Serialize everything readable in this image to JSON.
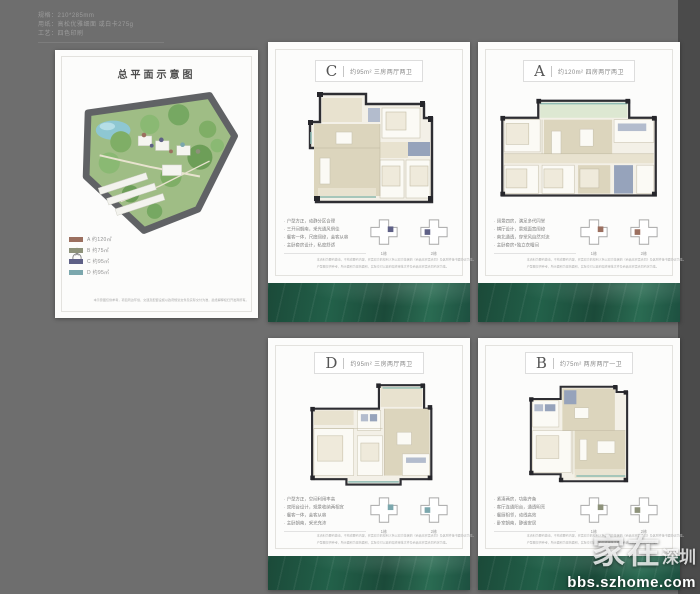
{
  "colors": {
    "background": "#6e6e6e",
    "right_strip": "#4b4b4b",
    "green_band": "#1e5140"
  },
  "print_specs": {
    "line1": "规格：210*285mm",
    "line2": "用纸：高松优雅细面 或白卡275g",
    "line3": "工艺：四色印刷"
  },
  "site_panel": {
    "title": "总平面示意图",
    "legend": [
      {
        "color": "#9b6f5f",
        "label": "A 约120㎡"
      },
      {
        "color": "#8d927a",
        "label": "B 约75㎡"
      },
      {
        "color": "#5e6086",
        "label": "C 约95㎡"
      },
      {
        "color": "#7ba7ad",
        "label": "D 约95㎡"
      }
    ],
    "disclaimer": "本示意图仅供参考，项目周边环境、交通及配套设施以政府规划文件及实际交付为准，最终解释权归开发商所有。"
  },
  "cards": [
    {
      "letter": "C",
      "spec": "约95m² 三房两厅两卫",
      "highlight": "#5e6086",
      "features": [
        "· 户型方正，动静分区合理",
        "· 三开间朝南，采光通风俱佳",
        "· 餐客一体，尺度阔绰，会客从容",
        "· 主卧套房设计，私密舒适"
      ],
      "keyplans": [
        "1栋",
        "2栋"
      ],
      "disclaimer1": "本资料为要约邀请，不构成要约内容，买卖双方的权利义务以双方签署的《商品房买卖合同》及其附件等书面协议为准。",
      "disclaimer2": "户型图仅供参考，所示面积为建筑面积，实际交付以政府最终审批文件及商品房买卖合同约定为准。"
    },
    {
      "letter": "A",
      "spec": "约120m² 四房两厅两卫",
      "highlight": "#9b6f5f",
      "features": [
        "· 阔景四房，满足多代同堂",
        "· 横厅设计，景观面宽阔绰",
        "· 南北通透，穿堂风自然对流",
        "· 主卧套房+独立衣帽间"
      ],
      "keyplans": [
        "1栋",
        "2栋"
      ],
      "disclaimer1": "本资料为要约邀请，不构成要约内容，买卖双方的权利义务以双方签署的《商品房买卖合同》及其附件等书面协议为准。",
      "disclaimer2": "户型图仅供参考，所示面积为建筑面积，实际交付以政府最终审批文件及商品房买卖合同约定为准。"
    },
    {
      "letter": "D",
      "spec": "约95m² 三房两厅两卫",
      "highlight": "#7ba7ad",
      "features": [
        "· 户型方正，空间利用率高",
        "· 双阳台设计，观景收纳两相宜",
        "· 餐客一体，会客从容",
        "· 主卧朝南，采光充沛"
      ],
      "keyplans": [
        "1栋",
        "2栋"
      ],
      "disclaimer1": "本资料为要约邀请，不构成要约内容，买卖双方的权利义务以双方签署的《商品房买卖合同》及其附件等书面协议为准。",
      "disclaimer2": "户型图仅供参考，所示面积为建筑面积，实际交付以政府最终审批文件及商品房买卖合同约定为准。"
    },
    {
      "letter": "B",
      "spec": "约75m² 两房两厅一卫",
      "highlight": "#8d927a",
      "features": [
        "· 紧凑两房，功能齐备",
        "· 客厅连通阳台，通透明亮",
        "· 餐厨相邻，动线高效",
        "· 卧室朝南，静谧安居"
      ],
      "keyplans": [
        "1栋",
        "2栋"
      ],
      "disclaimer1": "本资料为要约邀请，不构成要约内容，买卖双方的权利义务以双方签署的《商品房买卖合同》及其附件等书面协议为准。",
      "disclaimer2": "户型图仅供参考，所示面积为建筑面积，实际交付以政府最终审批文件及商品房买卖合同约定为准。"
    }
  ],
  "watermark": {
    "big": "家在",
    "small": "深圳",
    "url": "bbs.szhome.com"
  }
}
